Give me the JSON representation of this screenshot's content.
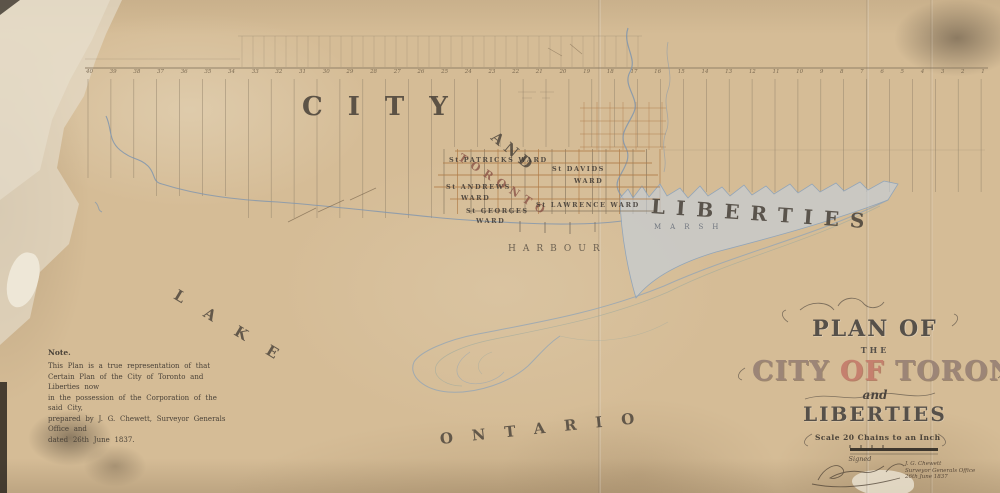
{
  "map": {
    "regions": {
      "city": "CITY",
      "and": "AND",
      "toronto_diagonal": "TORONTO",
      "liberties": "LIBERTIES",
      "harbour": "HARBOUR",
      "marsh": "MARSH",
      "lake": "LAKE",
      "ontario": "ONTARIO"
    },
    "wards": {
      "st_patricks": {
        "line1": "St PATRICKS WARD"
      },
      "st_davids": {
        "line1": "St DAVIDS",
        "line2": "WARD"
      },
      "st_andrews": {
        "line1": "St ANDREWS",
        "line2": "WARD"
      },
      "st_lawrence": {
        "line1": "St LAWRENCE WARD"
      },
      "st_georges": {
        "line1": "St GEORGES",
        "line2": "WARD"
      }
    },
    "top_lots": {
      "numbers": [
        "40",
        "39",
        "38",
        "37",
        "36",
        "35",
        "34",
        "33",
        "32",
        "31",
        "30",
        "29",
        "28",
        "27",
        "26",
        "25",
        "24",
        "23",
        "22",
        "21",
        "20",
        "19",
        "18",
        "17",
        "16",
        "15",
        "14",
        "13",
        "12",
        "11",
        "10",
        "9",
        "8",
        "7",
        "6",
        "5",
        "4",
        "3",
        "2",
        "1"
      ]
    }
  },
  "note": {
    "heading": "Note.",
    "lines": [
      "This Plan is a true representation of that",
      "Certain Plan of the City of Toronto and Liberties now",
      "in the possession of the Corporation of the said City,",
      "prepared by J. G. Chewett, Surveyor Generals Office and",
      "dated 26th June 1837."
    ]
  },
  "title_block": {
    "plan_of": "PLAN OF",
    "the": "THE",
    "city_word": "CITY",
    "of_word": "OF",
    "toronto_word": "TORONTO",
    "and": "and",
    "liberties": "LIBERTIES",
    "scale": "Scale 20 Chains to an Inch",
    "signed": "Signed",
    "credit_name": "J. G. Chewett",
    "credit_office": "Surveyor Generals Office",
    "credit_date": "26th June 1837"
  },
  "colors": {
    "paper": "#d5bc96",
    "water": "#7f95ae",
    "marsh_fill": "#c3cfda",
    "street_orange": "#b07c48",
    "ink_dark": "#474038",
    "title_mauve": "#9c8577",
    "title_red": "#c5806e"
  }
}
